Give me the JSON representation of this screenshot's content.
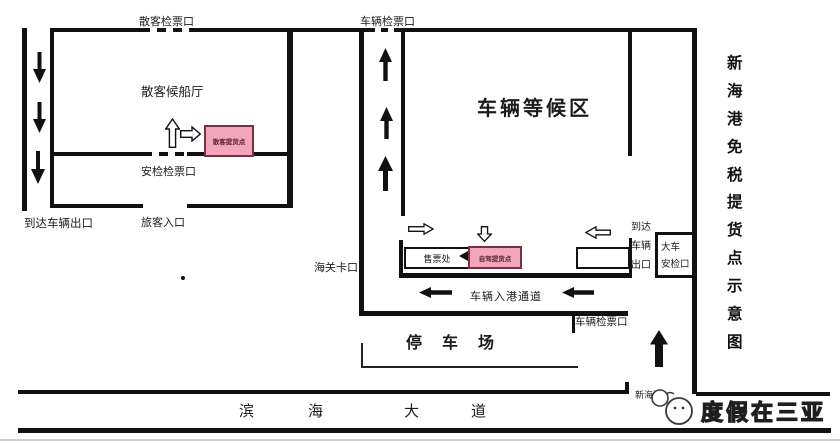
{
  "page": {
    "title_vertical": [
      "新",
      "海",
      "港",
      "免",
      "税",
      "提",
      "货",
      "点",
      "示",
      "意",
      "图"
    ],
    "watermark": "度假在三亚"
  },
  "areas": {
    "passenger_hall": "散客候船厅",
    "vehicle_waiting": "车辆等候区",
    "parking_lot": "停车场",
    "boulevard": [
      "滨",
      "海",
      "大",
      "道"
    ]
  },
  "gates": {
    "passenger_ticket_gate": "散客检票口",
    "vehicle_ticket_gate_top": "车辆检票口",
    "security_ticket_gate": "安检检票口",
    "passenger_entrance": "旅客入口",
    "arrival_vehicle_exit": "到达车辆出口",
    "customs_gate": "海关卡口",
    "vehicle_entry_channel": "车辆入港通道",
    "vehicle_ticket_gate_bottom": "车辆检票口",
    "arrival_vehicle_exit_gate": [
      "到达",
      "车辆",
      "出口"
    ],
    "truck_security_gate": [
      "大车",
      "安检口"
    ],
    "port_name": "新海港"
  },
  "pickup_points": {
    "walk_in_pickup": "散客提货点",
    "self_drive_pickup": "自驾提货点",
    "ticket_office": "售票处"
  },
  "colors": {
    "pickup_pink": "#F2A6BB",
    "pickup_border": "#7A3040",
    "line_black": "#111111"
  }
}
